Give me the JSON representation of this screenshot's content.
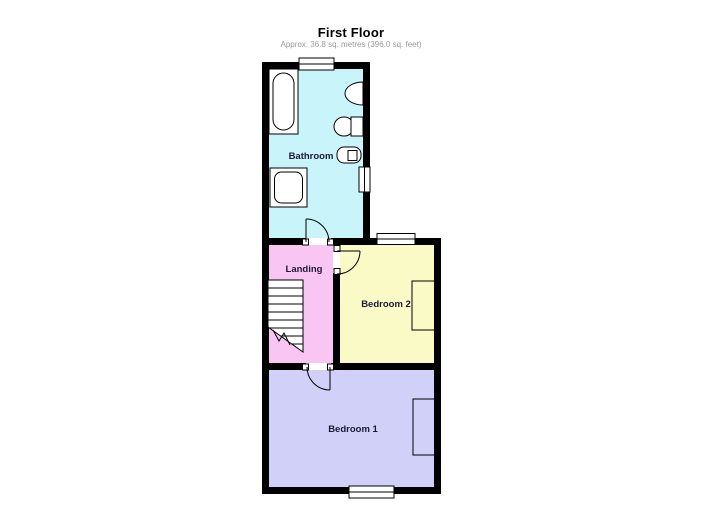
{
  "title": "First Floor",
  "subtitle": "Approx.  36.8 sq. metres (396.0 sq. feet)",
  "rooms": {
    "bathroom": {
      "label": "Bathroom",
      "color": "#c8f4fa"
    },
    "landing": {
      "label": "Landing",
      "color": "#f9c6f3"
    },
    "bedroom2": {
      "label": "Bedroom 2",
      "color": "#fafac6"
    },
    "bedroom1": {
      "label": "Bedroom 1",
      "color": "#d0d0f8"
    }
  },
  "colors": {
    "wall": "#000000",
    "fixture_fill": "#ffffff",
    "label_text": "#1a1a38",
    "title_text": "#000000",
    "subtitle_text": "#9a9a9a"
  },
  "fixtures": {
    "bathtub": "bathtub",
    "shower_tray": "shower-tray",
    "wash_basin": "wash-basin",
    "toilet": "toilet",
    "sink_unit": "sink-unit",
    "staircase": "staircase"
  }
}
